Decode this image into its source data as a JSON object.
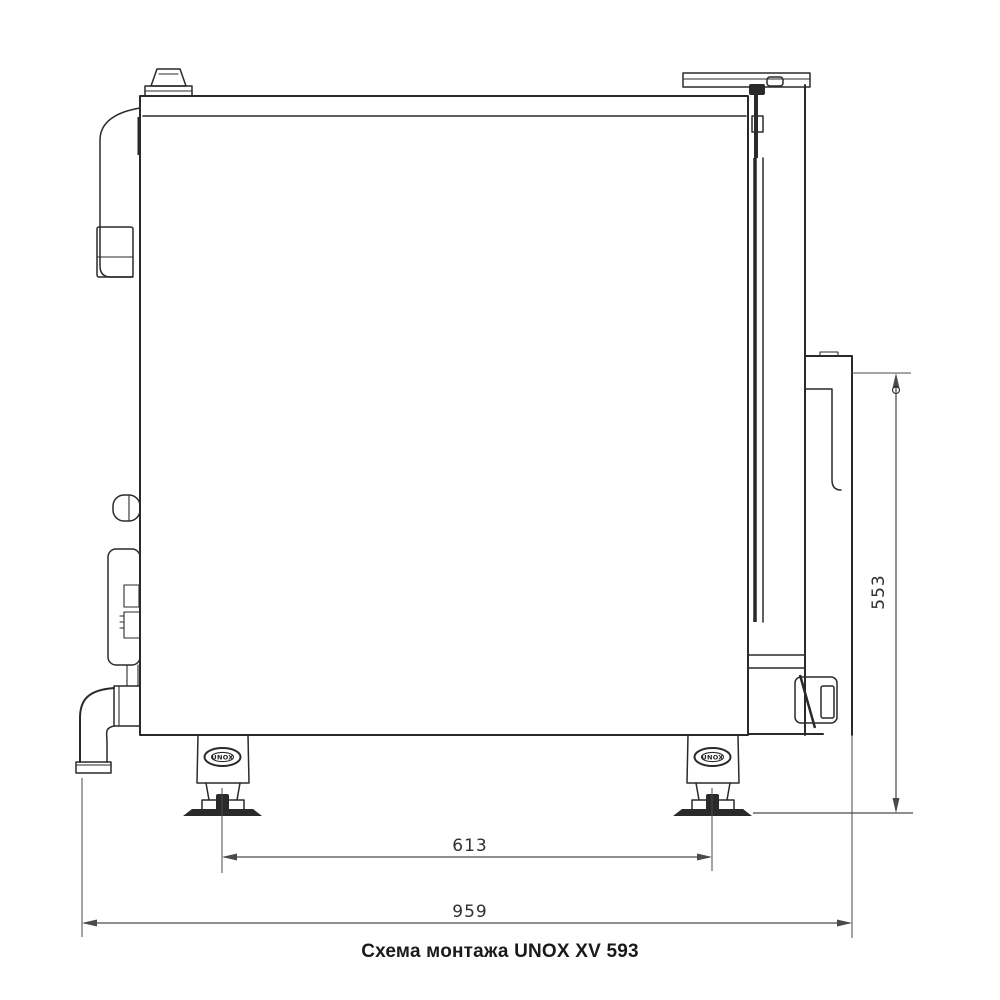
{
  "caption": "Схема монтажа UNOX XV 593",
  "dimensions": {
    "feet_spacing_mm": "613",
    "overall_width_mm": "959",
    "rear_height_mm": "553"
  },
  "feet": {
    "logo_text": "UNOX"
  },
  "colors": {
    "background": "#ffffff",
    "outline": "#2a2a2a",
    "dimension": "#4a4a4a",
    "caption_text": "#1a1a1a"
  }
}
